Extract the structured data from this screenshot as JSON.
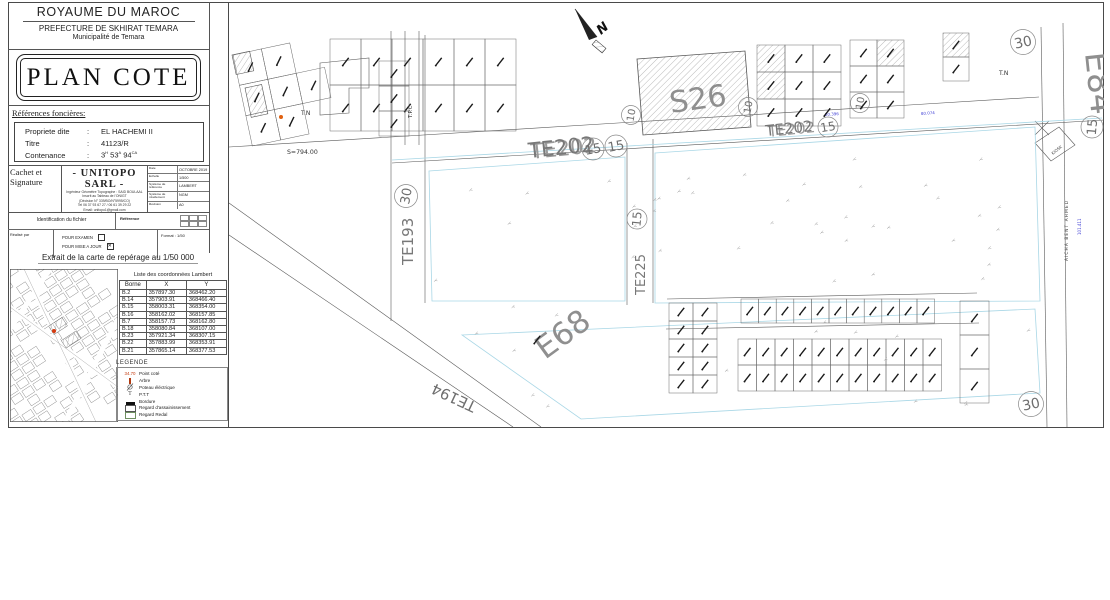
{
  "header": {
    "country": "ROYAUME DU MAROC",
    "prefecture": "PREFECTURE DE SKHIRAT TEMARA",
    "municipality": "Municipalité de Temara"
  },
  "title": "PLAN COTE",
  "land_references": {
    "section_title": "Références foncières:",
    "property_label": "Propriete dite",
    "property_value": "EL HACHEMI II",
    "title_label": "Titre",
    "title_value": "41123/R",
    "area_label": "Contenance",
    "area_parts": [
      "3",
      "H",
      "53",
      "A",
      "94",
      "CA"
    ]
  },
  "signature": {
    "label": "Cachet et Signature",
    "company": "- UNITOPO  SARL -",
    "lines": [
      "Ingénieur Géomètre Topographe : SAID BOULAAL",
      "Inscrit au Tableau de l'ONIGT",
      "(Décision N° 339/BO/N°5995/CO)",
      "Tel 06 37 93 67 27 / 06 61 39 29 22",
      "Email: unitopo1@gmail.com"
    ],
    "meta": [
      {
        "label": "Date",
        "value": "OCTOBRE 2019"
      },
      {
        "label": "Echelle",
        "value": "1/500"
      },
      {
        "label": "Système de référence",
        "value": "LAMBERT"
      },
      {
        "label": "Système de nivellement",
        "value": "NGM"
      },
      {
        "label": "Révision",
        "value": "A0"
      }
    ]
  },
  "file_identification": {
    "title": "Identification du fichier",
    "realised_label": "Réalisé par",
    "checkbox_examen": "POUR EXAMEN",
    "checkbox_mise_a_jour": "POUR MISE A JOUR",
    "reference_label": "Référence",
    "format_label": "Format : 1/50"
  },
  "map_extract": {
    "title": "Extrait de la carte de repérage au 1/50 000"
  },
  "coordinates": {
    "title": "Liste des coordonnées Lambert",
    "columns": [
      "Borne",
      "X",
      "Y"
    ],
    "rows": [
      [
        "B.2",
        "357897.30",
        "368462.20"
      ],
      [
        "B.14",
        "357903.91",
        "368466.40"
      ],
      [
        "B.15",
        "358003.31",
        "368354.00"
      ],
      [
        "B.16",
        "358162.02",
        "368157.85"
      ],
      [
        "B.7",
        "358157.73",
        "368162.80"
      ],
      [
        "B.18",
        "358080.84",
        "368107.00"
      ],
      [
        "B.23",
        "357921.34",
        "368307.15"
      ],
      [
        "B.22",
        "357883.99",
        "368353.91"
      ],
      [
        "B.21",
        "357865.14",
        "368377.53"
      ]
    ]
  },
  "legend": {
    "title": "LEGENDE",
    "spot_value": "34.70",
    "items": [
      {
        "symbol": "spot-elevation",
        "label": "Point coté"
      },
      {
        "symbol": "tree",
        "label": "Arbre"
      },
      {
        "symbol": "electric-pole",
        "label": "Poteau éléctrique"
      },
      {
        "symbol": "telecom",
        "label": "P.T.T"
      },
      {
        "symbol": "curb",
        "label": "Bordure"
      },
      {
        "symbol": "sewer-manhole",
        "label": "Regard d'assainissement"
      },
      {
        "symbol": "water-manhole",
        "label": "Regard Redal"
      }
    ]
  },
  "map": {
    "north": "N",
    "parcels": {
      "s26": "S26",
      "e68": "E68",
      "e84": "E84"
    },
    "roads": {
      "te202": "TE202",
      "te193": "TE193",
      "te194": "TE194",
      "te225": "TE225"
    },
    "street_name": "AICHA BENT AHMED",
    "kiosk": "KIOSK",
    "tn": "T.N",
    "tpc": "T.P.C",
    "area_s": "S=794.00",
    "badge_10": "10",
    "badge_15": "15",
    "badge_30": "30",
    "dims": {
      "d1": "20.396",
      "d2": "80.074",
      "d3": "101.411"
    }
  },
  "colors": {
    "dimension_blue": "#3b3bd4",
    "boundary_cyan": "#a9d7e6",
    "marker_orange": "#e06010",
    "label_grey": "#8a8a8a"
  }
}
